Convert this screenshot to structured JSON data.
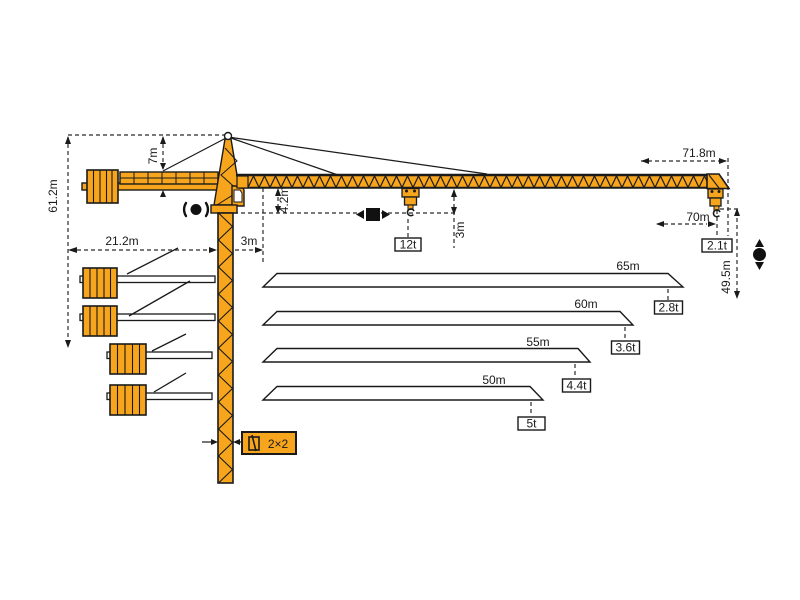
{
  "diagram": {
    "type": "tower-crane-load-diagram",
    "colors": {
      "crane_orange": "#F7A51C",
      "outline": "#1A1A1A",
      "background": "#FFFFFF"
    },
    "dims": {
      "total_height": "61.2m",
      "tower_head_height": "7m",
      "counter_jib_radius": "21.2m",
      "mast_offset": "3m",
      "jib_foot_depth": "4.2m",
      "hook_clearance": "3m",
      "jib_overall_length": "71.8m",
      "max_working_radius": "70m",
      "hook_height": "49.5m"
    },
    "loads": {
      "max_capacity": "12t",
      "tip_capacity": "2.1t"
    },
    "mast": {
      "section": "2×2"
    },
    "variants": [
      {
        "length": "65m",
        "tip_capacity": "2.8t"
      },
      {
        "length": "60m",
        "tip_capacity": "3.6t"
      },
      {
        "length": "55m",
        "tip_capacity": "4.4t"
      },
      {
        "length": "50m",
        "tip_capacity": "5t"
      }
    ],
    "symbols": [
      "slewing-icon",
      "trolley-travel-icon",
      "hoist-icon",
      "hook-icon",
      "mast-section-icon"
    ]
  }
}
